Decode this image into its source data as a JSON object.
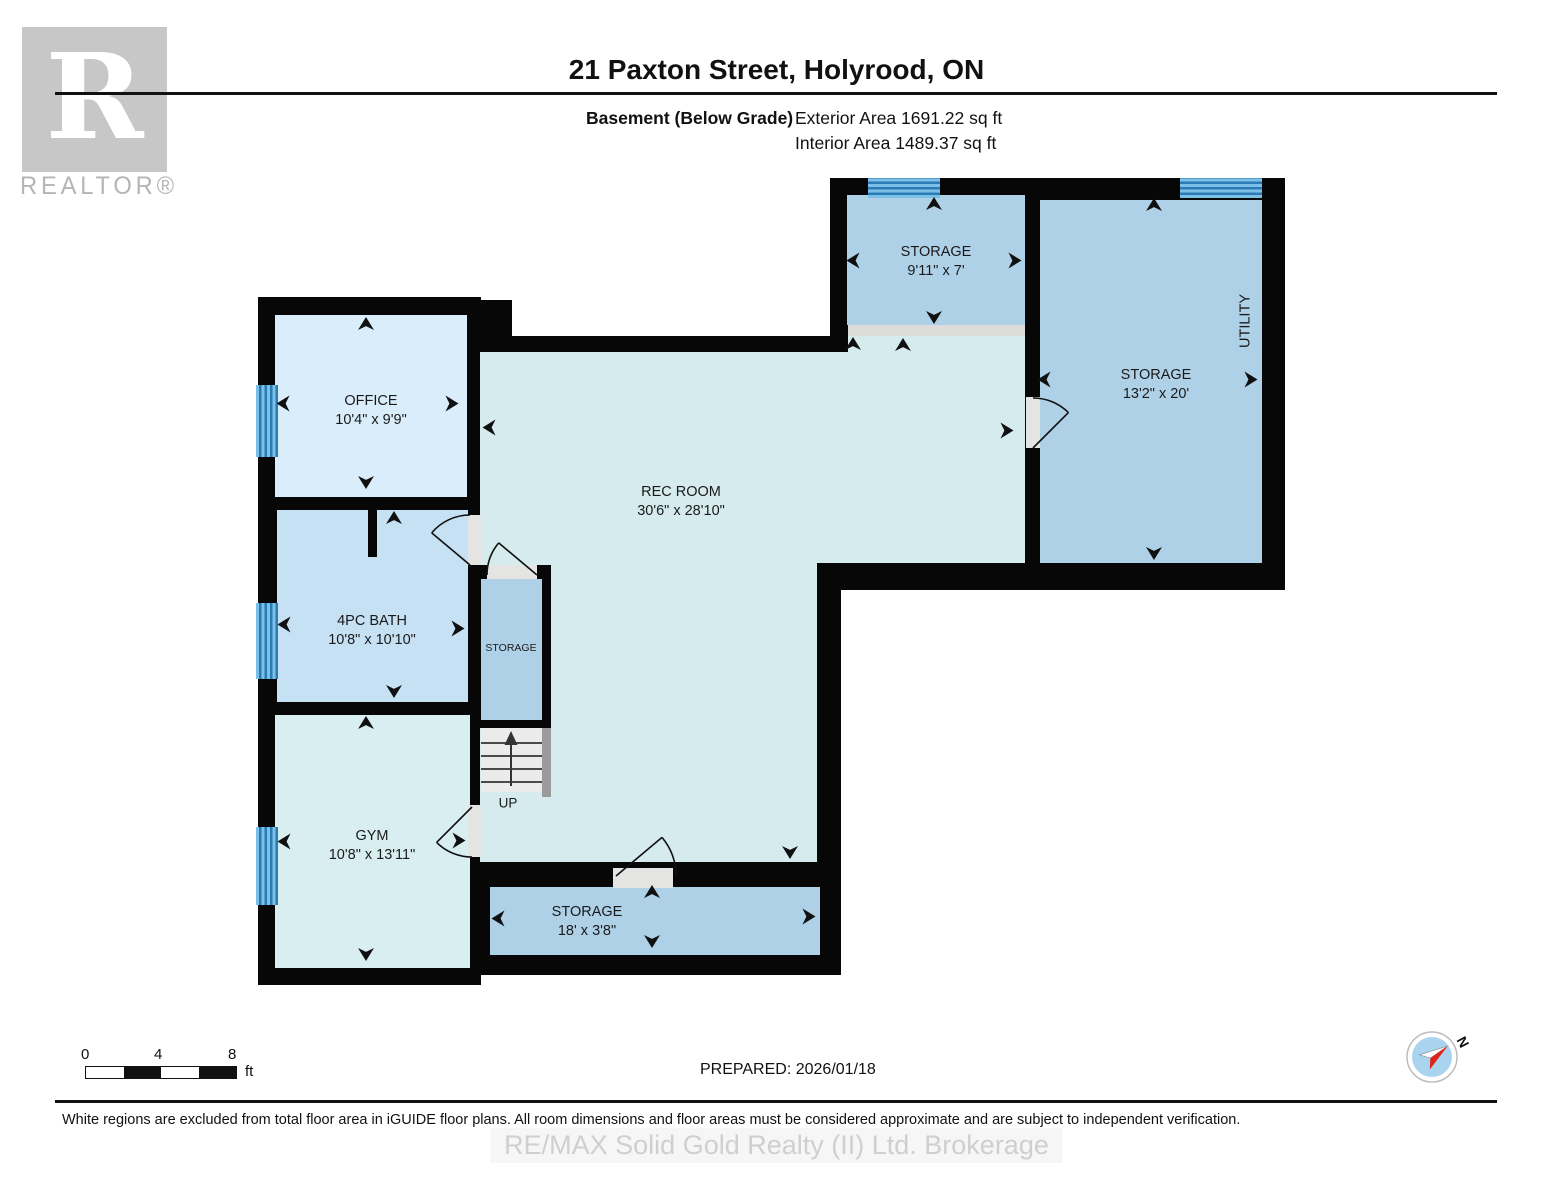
{
  "header": {
    "title": "21 Paxton Street, Holyrood, ON",
    "floor_label": "Basement (Below Grade)",
    "exterior_area": "Exterior Area 1691.22 sq ft",
    "interior_area": "Interior Area 1489.37 sq ft"
  },
  "branding": {
    "logo_letter": "R",
    "logo_wordmark": "REALTOR®",
    "watermark": "RE/MAX Solid Gold Realty (II) Ltd. Brokerage"
  },
  "rooms": {
    "office": {
      "name": "OFFICE",
      "dims": "10'4\" x 9'9\""
    },
    "bath": {
      "name": "4PC BATH",
      "dims": "10'8\" x 10'10\""
    },
    "gym": {
      "name": "GYM",
      "dims": "10'8\" x 13'11\""
    },
    "rec": {
      "name": "REC ROOM",
      "dims": "30'6\" x 28'10\""
    },
    "storage_top": {
      "name": "STORAGE",
      "dims": "9'11\" x 7'"
    },
    "storage_main": {
      "name": "STORAGE",
      "dims": "13'2\" x 20'"
    },
    "utility": {
      "name": "UTILITY"
    },
    "storage_closet": {
      "name": "STORAGE"
    },
    "storage_bottom": {
      "name": "STORAGE",
      "dims": "18' x 3'8\""
    }
  },
  "stairs": {
    "label": "UP"
  },
  "scale_bar": {
    "ticks": [
      "0",
      "4",
      "8"
    ],
    "unit": "ft"
  },
  "footer": {
    "prepared": "PREPARED: 2026/01/18",
    "disclaimer": "White regions are excluded from total floor area in iGUIDE floor plans. All room dimensions and floor areas must be considered approximate and are subject to independent verification.",
    "compass_north": "N"
  },
  "colors": {
    "wall": "#070707",
    "office_floor": "#d9edfa",
    "bath_floor": "#c6e0f4",
    "gym_floor": "#d8eef1",
    "rec_floor": "#d5ebee",
    "storage_floor": "#afd1e8",
    "window": "#4da0d4",
    "door_gap": "#e4e4e2",
    "stairs": "#ebebeb",
    "logo_gray": "#c7c7c7"
  }
}
